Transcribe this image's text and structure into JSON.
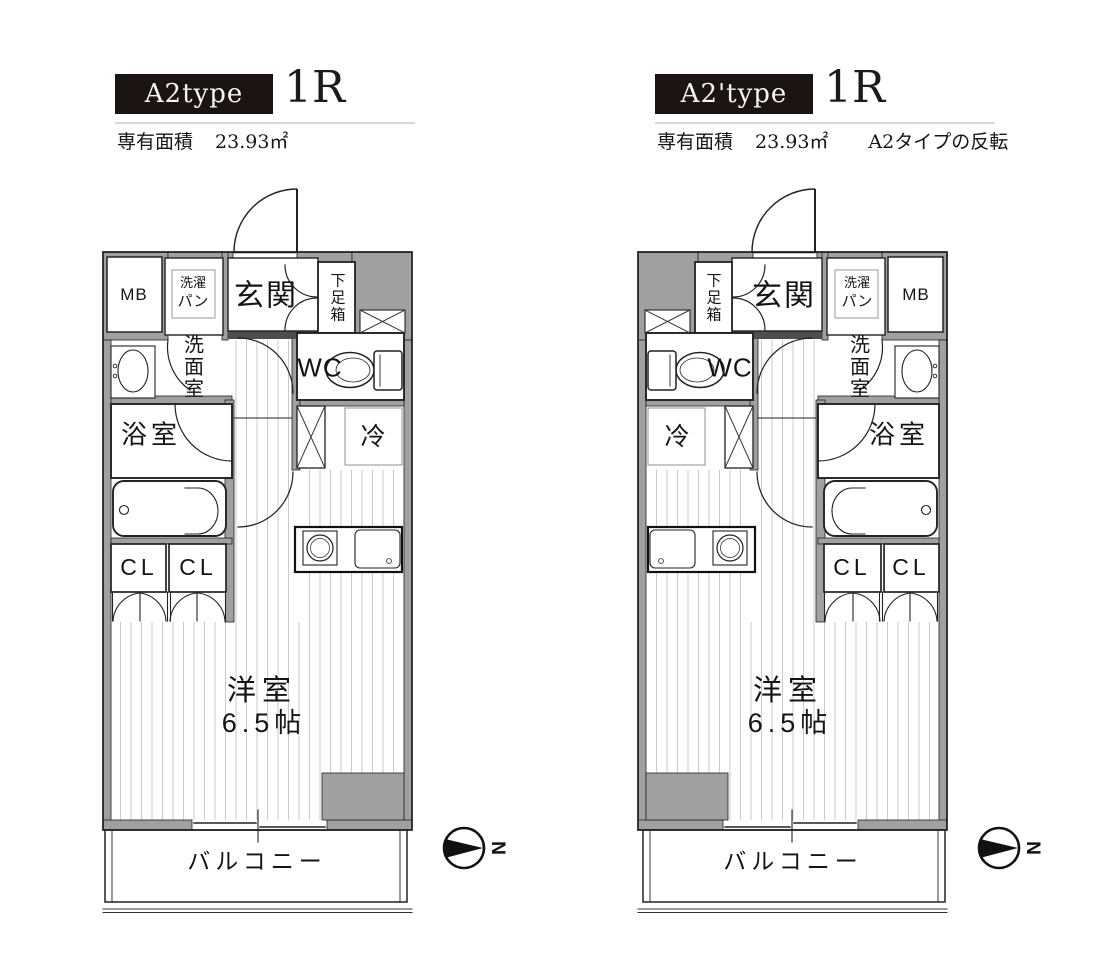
{
  "plans": [
    {
      "type_label": "A2type",
      "layout_label": "1R",
      "area_label": "専有面積",
      "area_value": "23.93㎡",
      "note": ""
    },
    {
      "type_label": "A2'type",
      "layout_label": "1R",
      "area_label": "専有面積",
      "area_value": "23.93㎡",
      "note": "A2タイプの反転"
    }
  ],
  "room_labels": {
    "mb": "MB",
    "laundry_top": "洗濯",
    "laundry_bottom": "パン",
    "entrance": "玄関",
    "shoe_box": "下足箱",
    "washroom": "洗面室",
    "toilet": "WC",
    "bath": "浴室",
    "fridge": "冷",
    "closet_left": "CL",
    "closet_right": "CL",
    "main_room": "洋室",
    "main_room_size": "6.5帖",
    "balcony": "バルコニー"
  },
  "compass": {
    "letter": "N"
  },
  "colors": {
    "wall_gray": "#a0a0a0",
    "entrance_step": "#4d4d4d",
    "header_box": "#1b1410",
    "divider": "#d8d8d8",
    "floor_line": "#c9c9c9"
  }
}
